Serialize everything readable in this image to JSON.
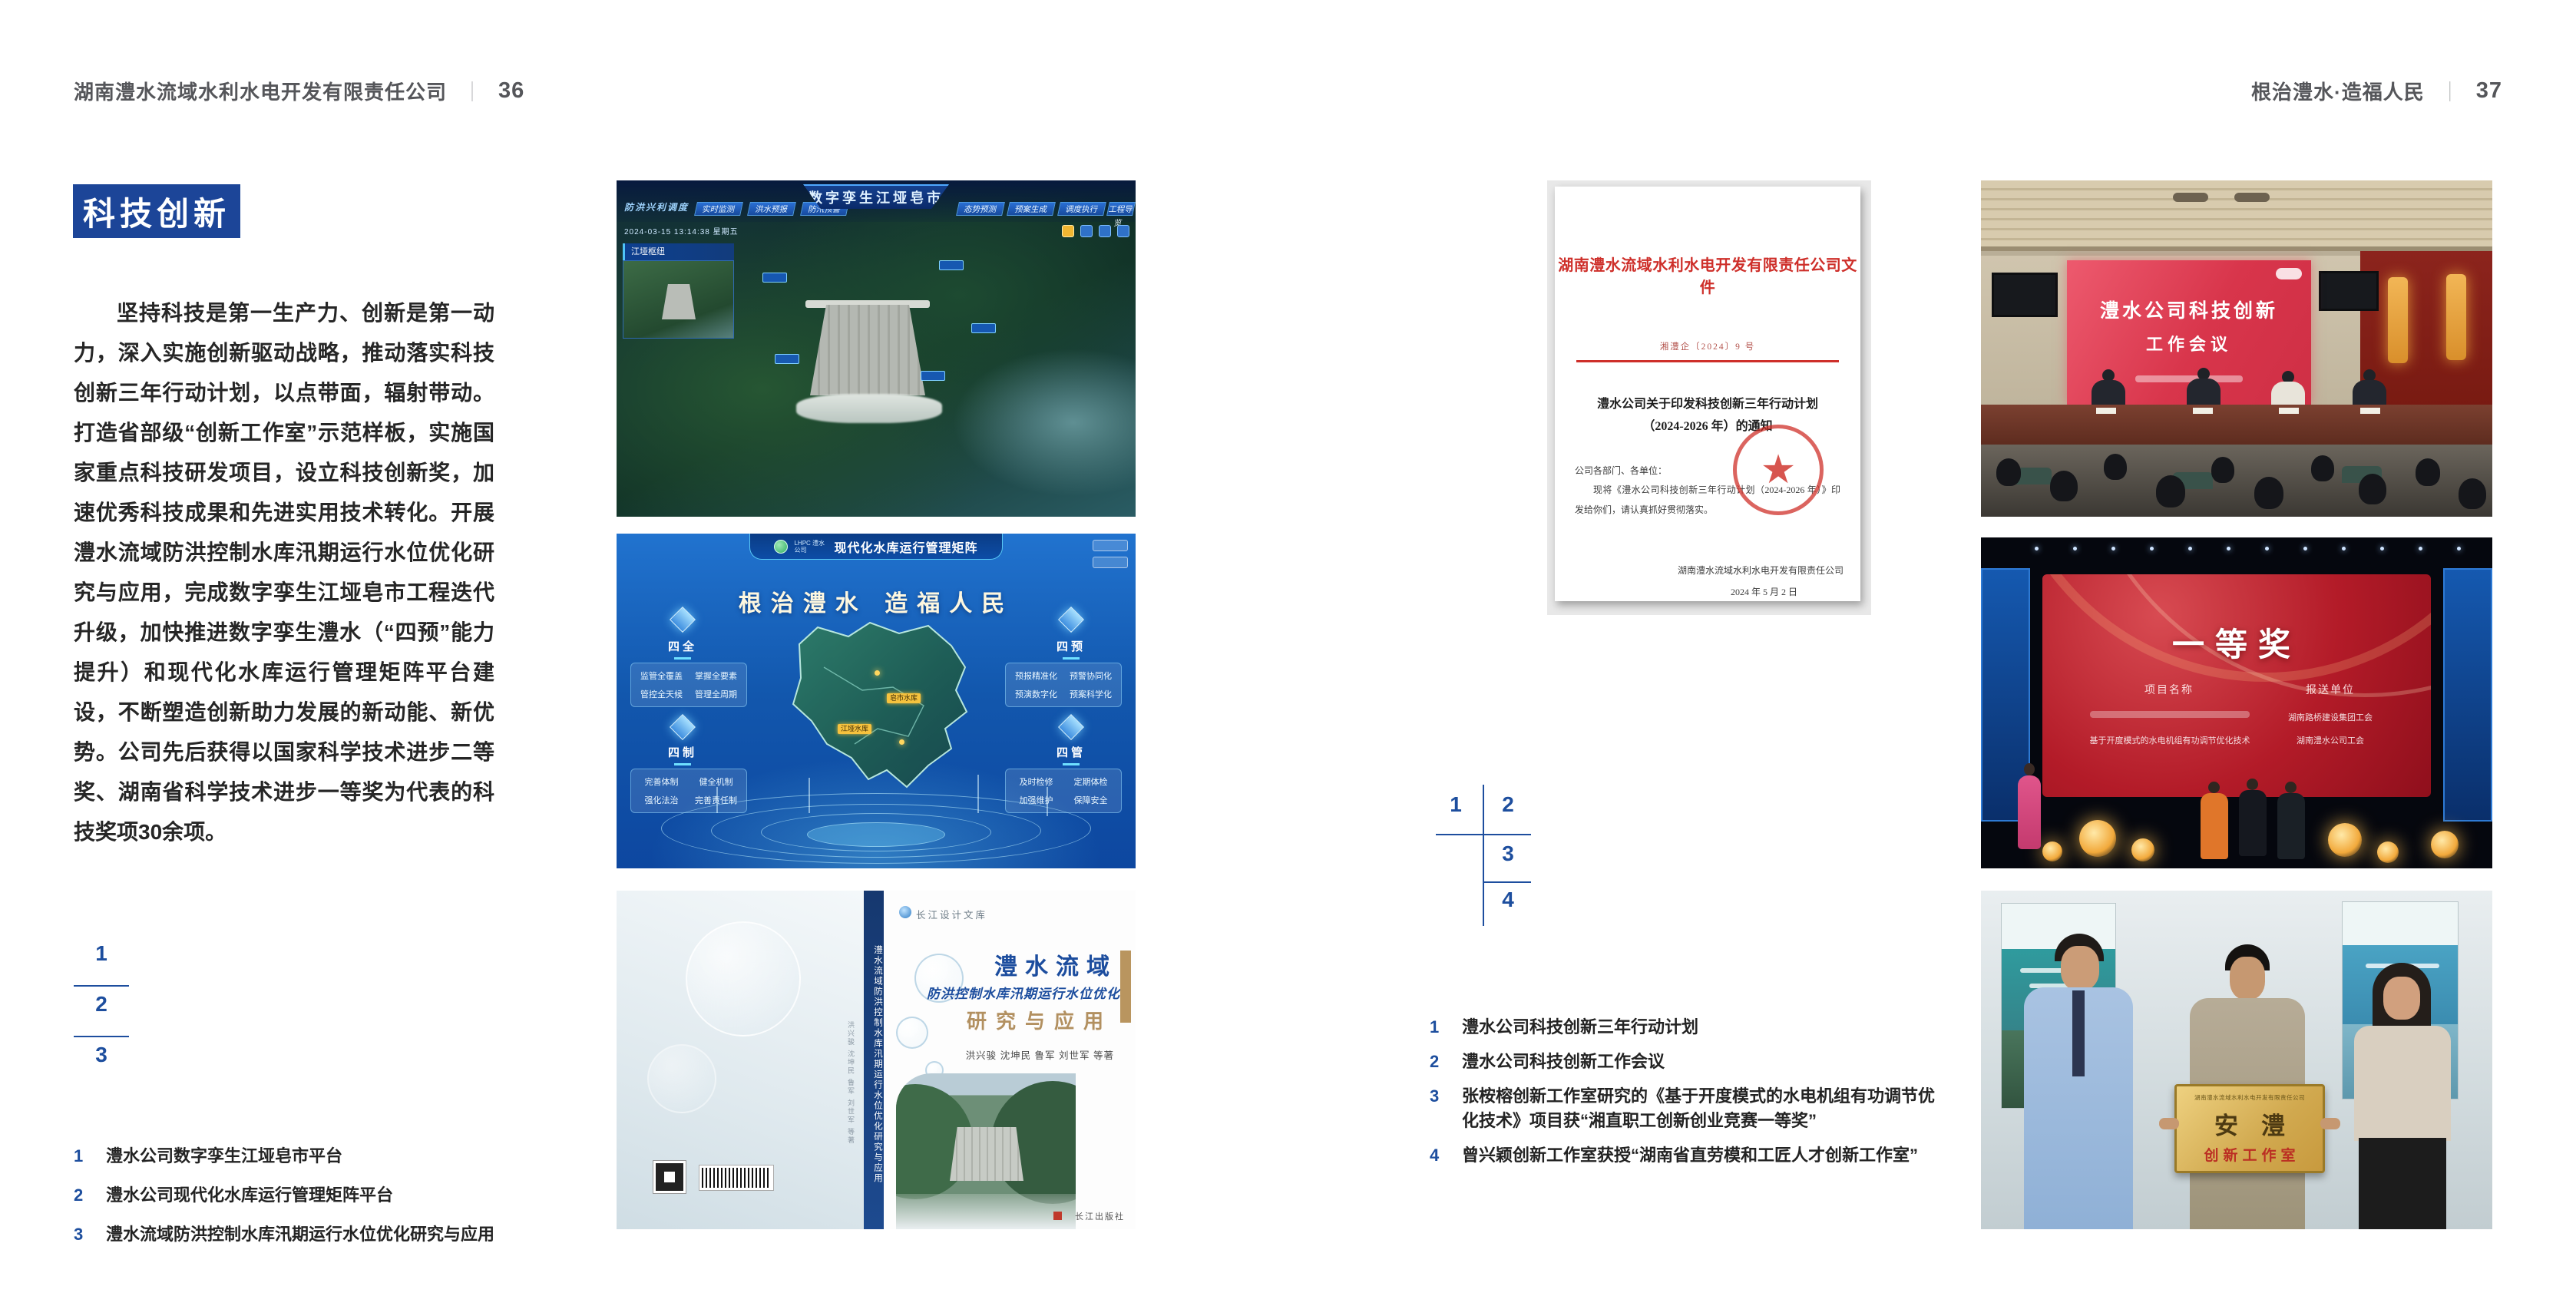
{
  "colors": {
    "accent_blue": "#1d4e9e",
    "section_blue": "#1c4598",
    "doc_red": "#ce2f2a",
    "book_tan": "#b29060",
    "plaque_gold": "#d1a94f"
  },
  "page_left": {
    "header": {
      "company": "湖南澧水流域水利水电开发有限责任公司",
      "separator": "｜",
      "page_number": "36"
    },
    "section_title": "科技创新",
    "body": "坚持科技是第一生产力、创新是第一动力，深入实施创新驱动战略，推动落实科技创新三年行动计划，以点带面，辐射带动。打造省部级“创新工作室”示范样板，实施国家重点科技研发项目，设立科技创新奖，加速优秀科技成果和先进实用技术转化。开展澧水流域防洪控制水库汛期运行水位优化研究与应用，完成数字孪生江垭皂市工程迭代升级，加快推进数字孪生澧水（“四预”能力提升）和现代化水库运行管理矩阵平台建设，不断塑造创新助力发展的新动能、新优势。公司先后获得以国家科学技术进步二等奖、湖南省科学技术进步一等奖为代表的科技奖项30余项。",
    "index_numbers": [
      "1",
      "2",
      "3"
    ],
    "captions": [
      {
        "num": "1",
        "text": "澧水公司数字孪生江垭皂市平台"
      },
      {
        "num": "2",
        "text": "澧水公司现代化水库运行管理矩阵平台"
      },
      {
        "num": "3",
        "text": "澧水流域防洪控制水库汛期运行水位优化研究与应用"
      }
    ]
  },
  "page_right": {
    "header": {
      "motto": "根治澧水·造福人民",
      "separator": "｜",
      "page_number": "37"
    },
    "index_numbers": [
      "1",
      "2",
      "3",
      "4"
    ],
    "captions": [
      {
        "num": "1",
        "text": "澧水公司科技创新三年行动计划"
      },
      {
        "num": "2",
        "text": "澧水公司科技创新工作会议"
      },
      {
        "num": "3",
        "text": "张桉榕创新工作室研究的《基于开度模式的水电机组有功调节优化技术》项目获“湘直职工创新创业竞赛一等奖”"
      },
      {
        "num": "4",
        "text": "曾兴颖创新工作室获授“湖南省直劳模和工匠人才创新工作室”"
      }
    ]
  },
  "figures": {
    "dashboard": {
      "corner_label": "防洪兴利调度",
      "title": "数字孪生江垭皂市",
      "tabs_left": [
        "实时监测",
        "洪水预报",
        "防汛预警"
      ],
      "tabs_right": [
        "态势预测",
        "预案生成",
        "调度执行",
        "工程导览"
      ],
      "timestamp": "2024-03-15 13:14:38 星期五",
      "panel_title": "江垭枢纽"
    },
    "matrix": {
      "logo_text": "LHPC 澧水公司",
      "header_title": "现代化水库运行管理矩阵",
      "slogan": "根治澧水 造福人民",
      "groups": [
        {
          "label": "四全",
          "items": [
            "监管全覆盖",
            "掌握全要素",
            "管控全天候",
            "管理全周期"
          ]
        },
        {
          "label": "四预",
          "items": [
            "预报精准化",
            "预警协同化",
            "预演数字化",
            "预案科学化"
          ]
        },
        {
          "label": "四制",
          "items": [
            "完善体制",
            "健全机制",
            "强化法治",
            "完善责任制"
          ]
        },
        {
          "label": "四管",
          "items": [
            "及时检修",
            "定期体检",
            "加强维护",
            "保障安全"
          ]
        }
      ],
      "markers": [
        "皂市水库",
        "江垭水库"
      ]
    },
    "book": {
      "series": "长江设计文库",
      "title_main": "澧水流域",
      "title_sub": "防洪控制水库汛期运行水位优化",
      "title_tail": "研究与应用",
      "authors": "洪兴骏 沈坤民 鲁军 刘世军 等著",
      "spine_title": "澧水流域防洪控制水库汛期运行水位优化研究与应用",
      "publisher": "长江出版社"
    },
    "document": {
      "red_title": "湖南澧水流域水利水电开发有限责任公司文件",
      "doc_no": "湘澧企〔2024〕9 号",
      "subject_line1": "澧水公司关于印发科技创新三年行动计划",
      "subject_line2": "（2024-2026 年）的通知",
      "salutation": "公司各部门、各单位：",
      "body": "现将《澧水公司科技创新三年行动计划（2024-2026 年）》印发给你们，请认真抓好贯彻落实。",
      "signer": "湖南澧水流域水利水电开发有限责任公司",
      "date": "2024 年 5 月 2 日"
    },
    "meeting": {
      "screen_line1": "澧水公司科技创新",
      "screen_line2": "工作会议"
    },
    "award": {
      "title": "一等奖",
      "col_project": "项目名称",
      "col_unit": "报送单位",
      "project_row2": "基于开度模式的水电机组有功调节优化技术",
      "unit_row1": "湖南路桥建设集团工会",
      "unit_row2": "湖南澧水公司工会"
    },
    "plaque": {
      "company": "湖南澧水流域水利水电开发有限责任公司",
      "name": "安澧",
      "label": "创新工作室"
    }
  }
}
